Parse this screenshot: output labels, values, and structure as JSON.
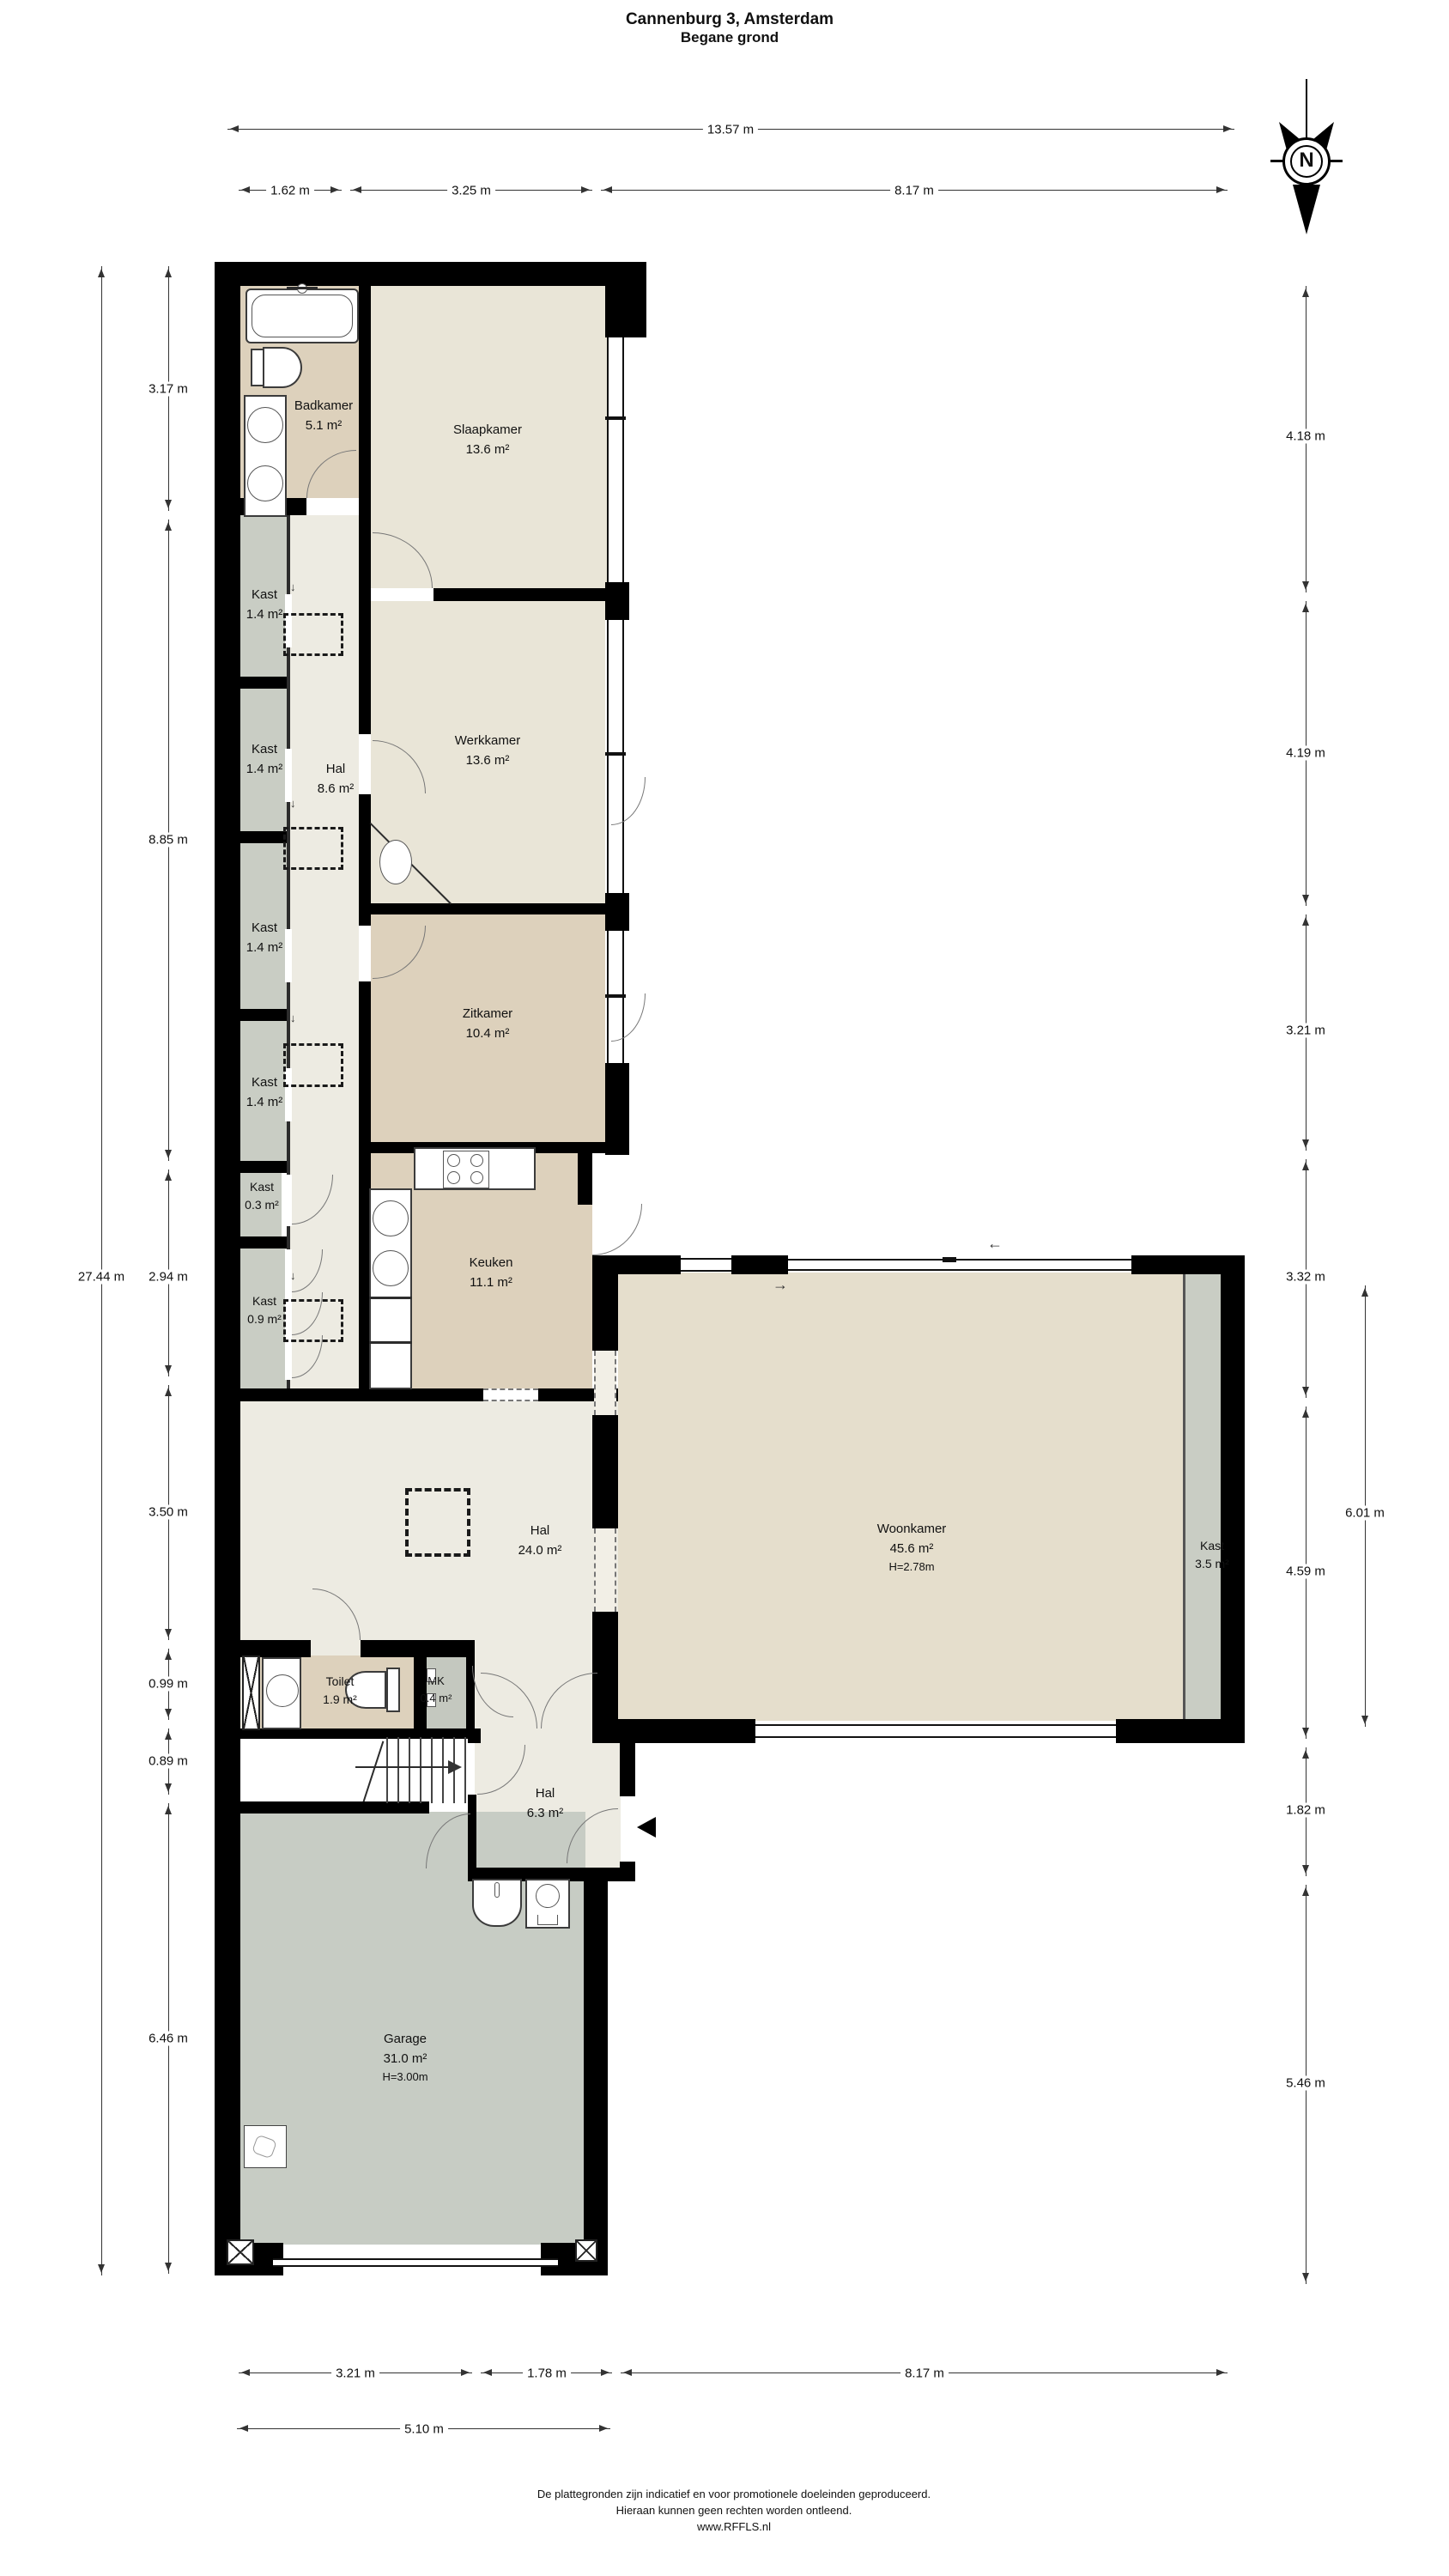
{
  "title": {
    "line1": "Cannenburg 3, Amsterdam",
    "line2": "Begane grond"
  },
  "compass": {
    "label": "N"
  },
  "rooms": {
    "badkamer": {
      "name": "Badkamer",
      "area": "5.1 m²"
    },
    "slaapkamer": {
      "name": "Slaapkamer",
      "area": "13.6 m²"
    },
    "kast1": {
      "name": "Kast",
      "area": "1.4 m²"
    },
    "kast2": {
      "name": "Kast",
      "area": "1.4 m²"
    },
    "kast3": {
      "name": "Kast",
      "area": "1.4 m²"
    },
    "kast4": {
      "name": "Kast",
      "area": "1.4 m²"
    },
    "hal1": {
      "name": "Hal",
      "area": "8.6 m²"
    },
    "werkkamer": {
      "name": "Werkkamer",
      "area": "13.6 m²"
    },
    "zitkamer": {
      "name": "Zitkamer",
      "area": "10.4 m²"
    },
    "kast03": {
      "name": "Kast",
      "area": "0.3 m²"
    },
    "kast09": {
      "name": "Kast",
      "area": "0.9 m²"
    },
    "keuken": {
      "name": "Keuken",
      "area": "11.1 m²"
    },
    "hal2": {
      "name": "Hal",
      "area": "24.0 m²"
    },
    "woonkamer": {
      "name": "Woonkamer",
      "area": "45.6 m²",
      "height": "H=2.78m"
    },
    "kast35": {
      "name": "Kast",
      "area": "3.5 m²"
    },
    "toilet": {
      "name": "Toilet",
      "area": "1.9 m²"
    },
    "mk": {
      "name": "MK",
      "area": "0.4 m²"
    },
    "hal3": {
      "name": "Hal",
      "area": "6.3 m²"
    },
    "garage": {
      "name": "Garage",
      "area": "31.0 m²",
      "height": "H=3.00m"
    }
  },
  "dims": {
    "width_total": "13.57 m",
    "top": [
      "1.62 m",
      "3.25 m",
      "8.17 m"
    ],
    "left_total": "27.44 m",
    "left": [
      "3.17 m",
      "8.85 m",
      "2.94 m",
      "3.50 m",
      "0.99 m",
      "0.89 m",
      "6.46 m"
    ],
    "right": [
      "4.18 m",
      "4.19 m",
      "3.21 m",
      "3.32 m",
      "4.59 m",
      "1.82 m",
      "5.46 m"
    ],
    "right_inner": "6.01 m",
    "bottom": [
      "3.21 m",
      "1.78 m",
      "8.17 m"
    ],
    "bottom_total": "5.10 m"
  },
  "icons": {
    "down_tick": "↓",
    "slide_right": "→",
    "slide_left": "←"
  },
  "colors": {
    "wall": "#000000",
    "tan": "#ddd1bc",
    "beige": "#e9e5d7",
    "hal": "#edebe2",
    "kast_gray": "#c9cdc4",
    "garage_gray": "#c7ccc4",
    "woonkamer": "#e5decc"
  },
  "footer": {
    "line1": "De plattegronden zijn indicatief en voor promotionele doeleinden geproduceerd.",
    "line2": "Hieraan kunnen geen rechten worden ontleend.",
    "line3": "www.RFFLS.nl"
  }
}
